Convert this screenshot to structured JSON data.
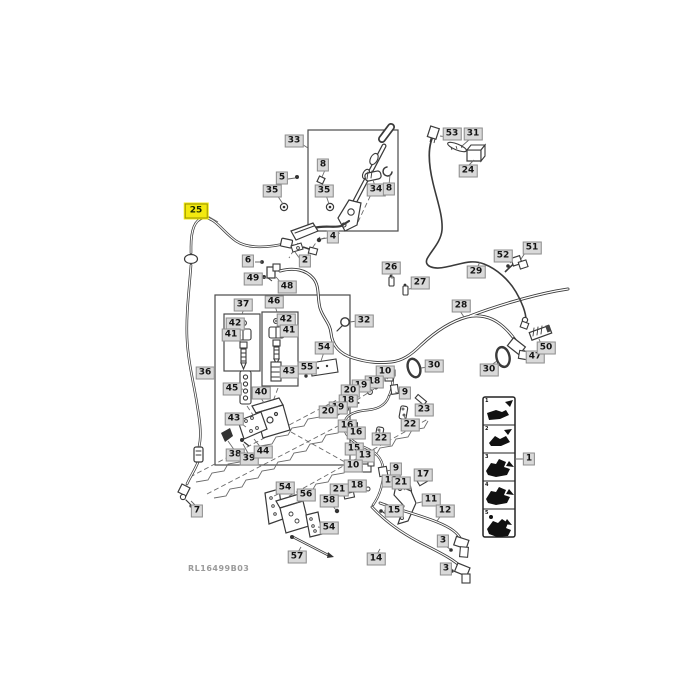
{
  "diagram": {
    "figure_code": "RL16499B03",
    "highlighted_part": "25",
    "label_bg": "#d9d9d9",
    "highlight_color": "#f3e90f",
    "legend": {
      "pointer_label": "1",
      "cells": [
        "1",
        "2",
        "3",
        "4",
        "5"
      ]
    },
    "labels": [
      {
        "t": "33",
        "x": 294,
        "y": 141
      },
      {
        "t": "5",
        "x": 282,
        "y": 178
      },
      {
        "t": "8",
        "x": 323,
        "y": 165
      },
      {
        "t": "35",
        "x": 272,
        "y": 191
      },
      {
        "t": "35",
        "x": 324,
        "y": 191
      },
      {
        "t": "34",
        "x": 376,
        "y": 190
      },
      {
        "t": "8",
        "x": 389,
        "y": 189
      },
      {
        "t": "4",
        "x": 333,
        "y": 237
      },
      {
        "t": "25",
        "x": 196,
        "y": 211,
        "h": true
      },
      {
        "t": "53",
        "x": 452,
        "y": 134
      },
      {
        "t": "31",
        "x": 473,
        "y": 134
      },
      {
        "t": "24",
        "x": 468,
        "y": 171
      },
      {
        "t": "6",
        "x": 248,
        "y": 261
      },
      {
        "t": "2",
        "x": 305,
        "y": 261
      },
      {
        "t": "49",
        "x": 253,
        "y": 279
      },
      {
        "t": "48",
        "x": 287,
        "y": 287
      },
      {
        "t": "26",
        "x": 391,
        "y": 268
      },
      {
        "t": "27",
        "x": 420,
        "y": 283
      },
      {
        "t": "29",
        "x": 476,
        "y": 272
      },
      {
        "t": "51",
        "x": 532,
        "y": 248
      },
      {
        "t": "52",
        "x": 503,
        "y": 256
      },
      {
        "t": "28",
        "x": 461,
        "y": 306
      },
      {
        "t": "32",
        "x": 364,
        "y": 321
      },
      {
        "t": "37",
        "x": 243,
        "y": 305
      },
      {
        "t": "46",
        "x": 274,
        "y": 302
      },
      {
        "t": "42",
        "x": 235,
        "y": 324
      },
      {
        "t": "41",
        "x": 231,
        "y": 335
      },
      {
        "t": "42",
        "x": 286,
        "y": 320
      },
      {
        "t": "41",
        "x": 289,
        "y": 331
      },
      {
        "t": "43",
        "x": 289,
        "y": 372
      },
      {
        "t": "45",
        "x": 232,
        "y": 389
      },
      {
        "t": "40",
        "x": 261,
        "y": 393
      },
      {
        "t": "54",
        "x": 324,
        "y": 348
      },
      {
        "t": "55",
        "x": 307,
        "y": 368
      },
      {
        "t": "36",
        "x": 205,
        "y": 373
      },
      {
        "t": "43",
        "x": 234,
        "y": 419
      },
      {
        "t": "38",
        "x": 235,
        "y": 455
      },
      {
        "t": "39",
        "x": 249,
        "y": 459
      },
      {
        "t": "44",
        "x": 263,
        "y": 452
      },
      {
        "t": "7",
        "x": 197,
        "y": 511
      },
      {
        "t": "30",
        "x": 434,
        "y": 366
      },
      {
        "t": "30",
        "x": 489,
        "y": 370
      },
      {
        "t": "47",
        "x": 535,
        "y": 357
      },
      {
        "t": "50",
        "x": 546,
        "y": 348
      },
      {
        "t": "10",
        "x": 385,
        "y": 372
      },
      {
        "t": "18",
        "x": 374,
        "y": 382
      },
      {
        "t": "19",
        "x": 361,
        "y": 386
      },
      {
        "t": "20",
        "x": 350,
        "y": 391
      },
      {
        "t": "18",
        "x": 348,
        "y": 401
      },
      {
        "t": "19",
        "x": 338,
        "y": 408
      },
      {
        "t": "20",
        "x": 328,
        "y": 412
      },
      {
        "t": "9",
        "x": 405,
        "y": 393
      },
      {
        "t": "23",
        "x": 424,
        "y": 410
      },
      {
        "t": "22",
        "x": 410,
        "y": 425
      },
      {
        "t": "16",
        "x": 347,
        "y": 426
      },
      {
        "t": "16",
        "x": 356,
        "y": 433
      },
      {
        "t": "22",
        "x": 381,
        "y": 439
      },
      {
        "t": "15",
        "x": 354,
        "y": 449
      },
      {
        "t": "13",
        "x": 365,
        "y": 456
      },
      {
        "t": "10",
        "x": 353,
        "y": 466
      },
      {
        "t": "9",
        "x": 396,
        "y": 469
      },
      {
        "t": "18",
        "x": 391,
        "y": 481
      },
      {
        "t": "18",
        "x": 357,
        "y": 486
      },
      {
        "t": "17",
        "x": 423,
        "y": 475
      },
      {
        "t": "21",
        "x": 401,
        "y": 483
      },
      {
        "t": "21",
        "x": 339,
        "y": 490
      },
      {
        "t": "58",
        "x": 329,
        "y": 501
      },
      {
        "t": "15",
        "x": 394,
        "y": 511
      },
      {
        "t": "11",
        "x": 431,
        "y": 500
      },
      {
        "t": "12",
        "x": 445,
        "y": 511
      },
      {
        "t": "54",
        "x": 285,
        "y": 488
      },
      {
        "t": "56",
        "x": 306,
        "y": 495
      },
      {
        "t": "54",
        "x": 329,
        "y": 528
      },
      {
        "t": "57",
        "x": 297,
        "y": 557
      },
      {
        "t": "14",
        "x": 376,
        "y": 559
      },
      {
        "t": "3",
        "x": 443,
        "y": 541
      },
      {
        "t": "3",
        "x": 446,
        "y": 569
      },
      {
        "t": "1",
        "x": 529,
        "y": 459
      }
    ]
  }
}
